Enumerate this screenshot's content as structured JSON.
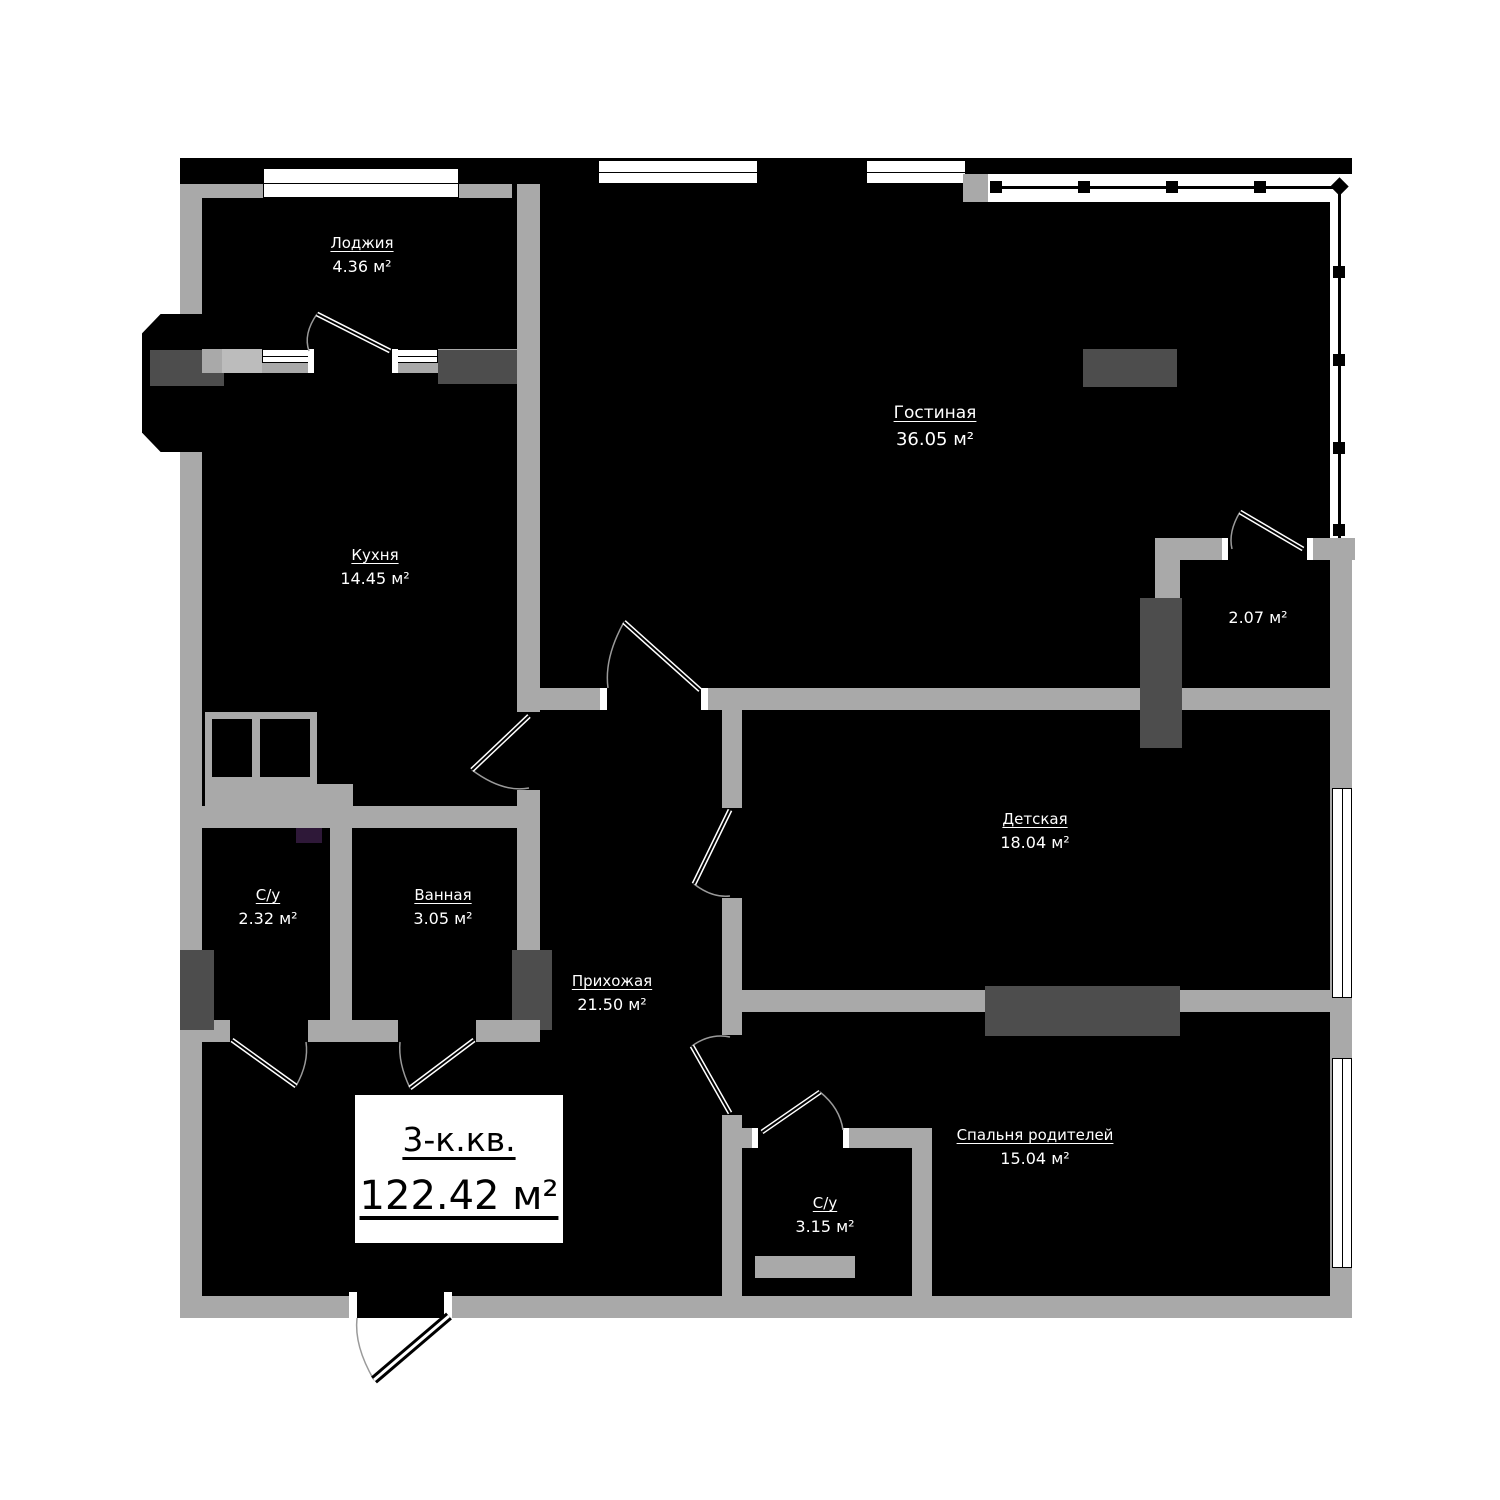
{
  "plan": {
    "title": {
      "type_label": "3-к.кв.",
      "area_label": "122.42 м²"
    },
    "rooms": [
      {
        "id": "loggia",
        "name": "Лоджия",
        "area": "4.36 м²"
      },
      {
        "id": "living",
        "name": "Гостиная",
        "area": "36.05 м²"
      },
      {
        "id": "kitchen",
        "name": "Кухня",
        "area": "14.45 м²"
      },
      {
        "id": "wardrobe",
        "name": "",
        "area": "2.07 м²"
      },
      {
        "id": "children",
        "name": "Детская",
        "area": "18.04 м²"
      },
      {
        "id": "wc1",
        "name": "С/у",
        "area": "2.32 м²"
      },
      {
        "id": "bathroom",
        "name": "Ванная",
        "area": "3.05 м²"
      },
      {
        "id": "hallway",
        "name": "Прихожая",
        "area": "21.50 м²"
      },
      {
        "id": "bedroom",
        "name": "Спальня родителей",
        "area": "15.04 м²"
      },
      {
        "id": "wc2",
        "name": "С/у",
        "area": "3.15 м²"
      }
    ],
    "colors": {
      "wall": "#a9a9a9",
      "dark_block": "#4d4d4d",
      "fill": "#000000",
      "accent": "#2e1838"
    }
  }
}
